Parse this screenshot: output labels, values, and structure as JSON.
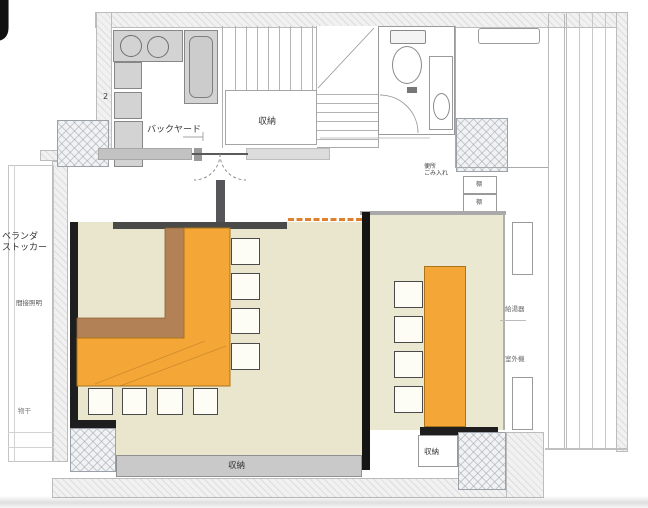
{
  "corner_glyph": "J",
  "labels": {
    "backyard": "バックヤード",
    "stair_number": "2",
    "closet_top": "収納",
    "storage_bottom": "収納",
    "storage_right": "収納",
    "veranda_stocker_line1": "ベランダ",
    "veranda_stocker_line2": "ストッカー",
    "indirect_lighting": "間接照明",
    "laundry_hook": "物干",
    "hall_note_line1": "便所",
    "hall_note_line2": "ごみ入れ",
    "shelf_top": "棚",
    "shelf_bottom": "棚",
    "water_heater": "給湯器",
    "outdoor_unit": "室外機"
  },
  "colors": {
    "counter_orange": "#f4a636",
    "counter_edge": "#a8741c",
    "bench_brown": "#b28156",
    "floor_beige_left": "#e9e6cd",
    "floor_beige_right": "#eae8d0",
    "wall_black": "#1e1e1e",
    "wall_dark_gray": "#4a4a48",
    "storage_gray": "#c9c9c9",
    "opening_dash_orange": "#e07f2e",
    "wall_light_gray": "#dddddd",
    "kitchen_unit_gray": "#d3d3d3"
  }
}
